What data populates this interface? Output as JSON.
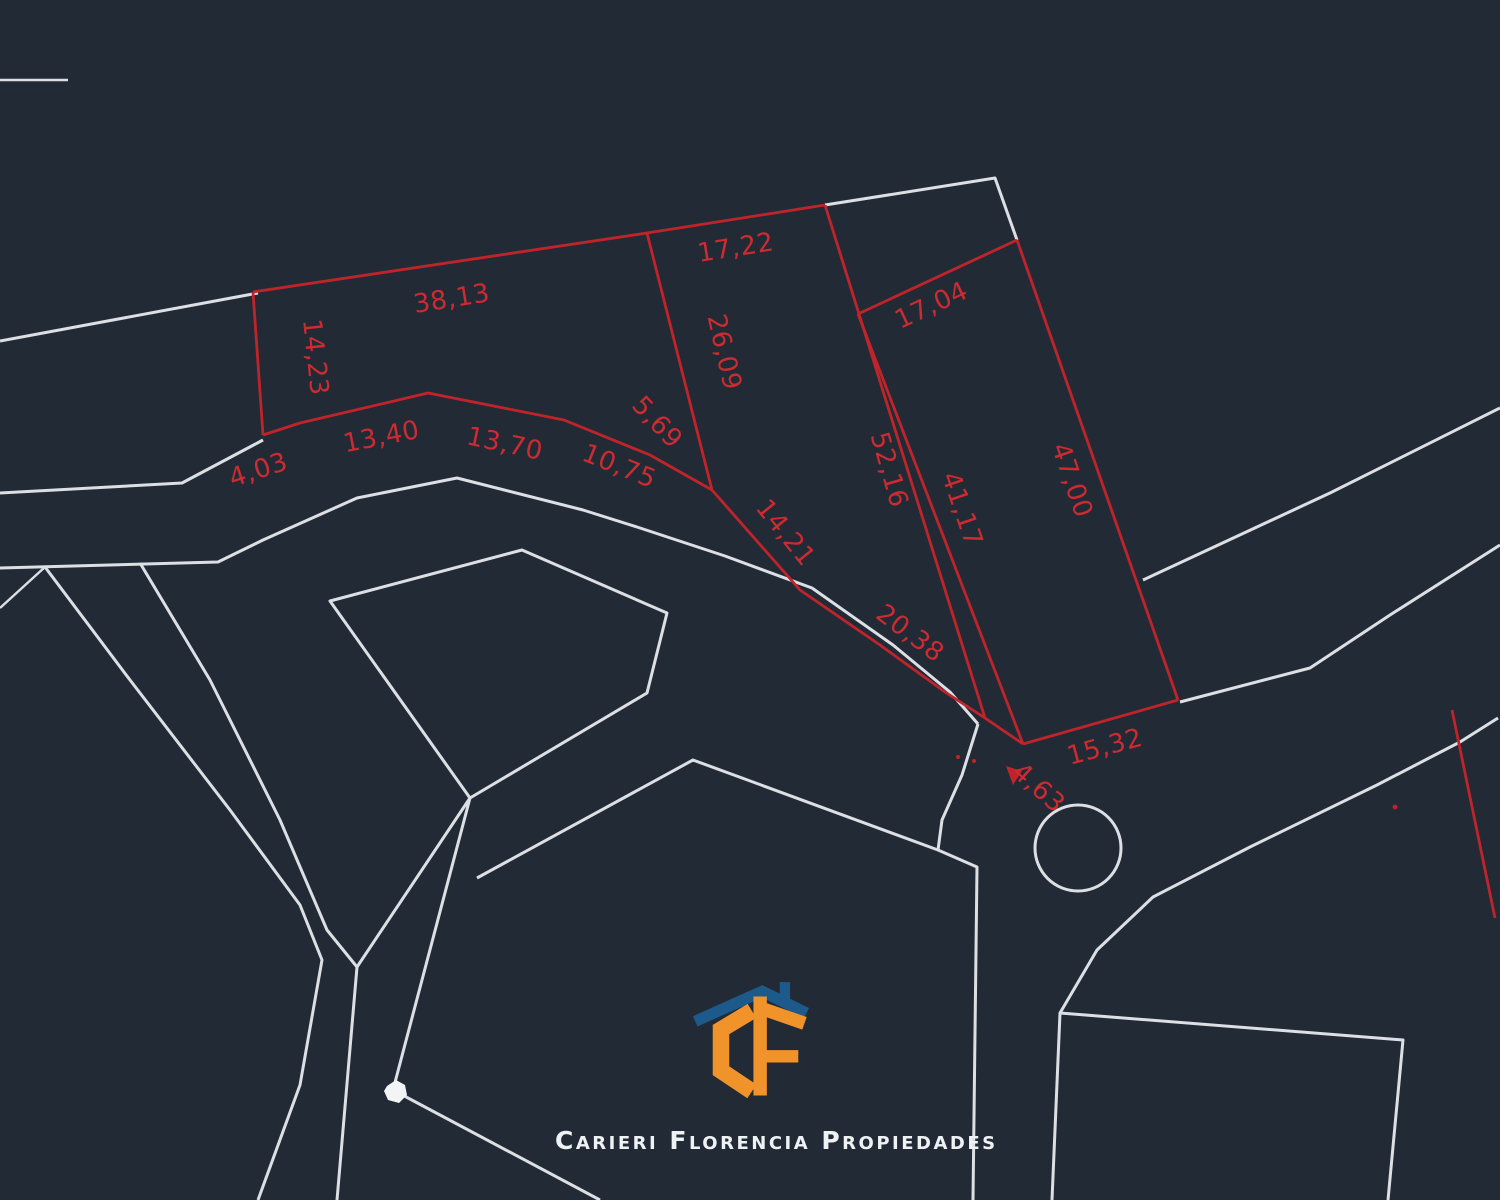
{
  "palette": {
    "background": "#222A35",
    "street_line": "#DCE0E5",
    "parcel_line": "#C0242B",
    "dimension_text": "#CB2B31",
    "logo_orange": "#F0932B",
    "logo_blue": "#1D5A8C",
    "logo_text": "#EFF2F4"
  },
  "logo": {
    "company": "Carieri Florencia Propiedades",
    "monogram": "CF"
  },
  "dimensions": [
    {
      "label": "38,13",
      "x": 453,
      "y": 307,
      "angle": -9
    },
    {
      "label": "17,22",
      "x": 737,
      "y": 256,
      "angle": -9
    },
    {
      "label": "14,23",
      "x": 307,
      "y": 358,
      "angle": 84
    },
    {
      "label": "26,09",
      "x": 716,
      "y": 354,
      "angle": 77
    },
    {
      "label": "4,03",
      "x": 261,
      "y": 478,
      "angle": -18
    },
    {
      "label": "13,40",
      "x": 383,
      "y": 445,
      "angle": -11
    },
    {
      "label": "13,70",
      "x": 503,
      "y": 452,
      "angle": 12
    },
    {
      "label": "10,75",
      "x": 616,
      "y": 474,
      "angle": 22
    },
    {
      "label": "5,69",
      "x": 651,
      "y": 428,
      "angle": 47
    },
    {
      "label": "14,21",
      "x": 779,
      "y": 538,
      "angle": 51
    },
    {
      "label": "20,38",
      "x": 905,
      "y": 640,
      "angle": 37
    },
    {
      "label": "52,16",
      "x": 881,
      "y": 472,
      "angle": 74
    },
    {
      "label": "41,17",
      "x": 954,
      "y": 512,
      "angle": 71
    },
    {
      "label": "17,04",
      "x": 935,
      "y": 313,
      "angle": -25
    },
    {
      "label": "47,00",
      "x": 1064,
      "y": 483,
      "angle": 71
    },
    {
      "label": "15,32",
      "x": 1107,
      "y": 755,
      "angle": -15
    },
    {
      "label": "4,63",
      "x": 1033,
      "y": 794,
      "angle": 42
    }
  ]
}
